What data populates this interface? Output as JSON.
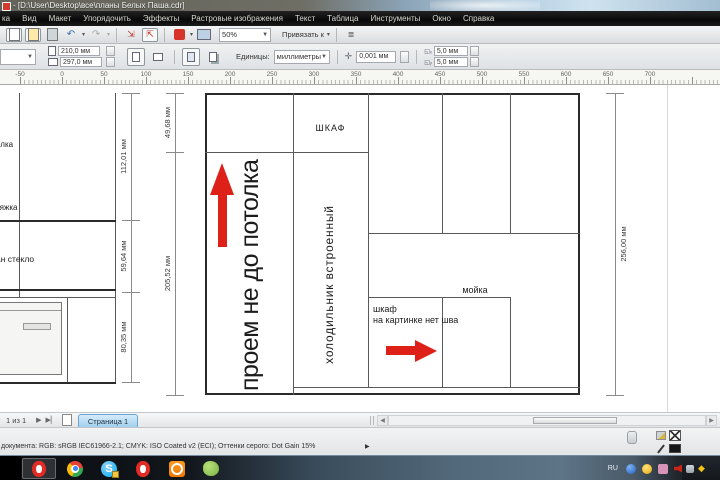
{
  "window": {
    "title": "- [D:\\User\\Desktop\\все\\планы Белых Паша.cdr]"
  },
  "menu": {
    "items": [
      "ка",
      "Вид",
      "Макет",
      "Упорядочить",
      "Эффекты",
      "Растровые изображения",
      "Текст",
      "Таблица",
      "Инструменты",
      "Окно",
      "Справка"
    ]
  },
  "toolbar": {
    "zoom_value": "50%",
    "snap_label": "Привязать к"
  },
  "property_bar": {
    "page_width": "210,0 мм",
    "page_height": "297,0 мм",
    "units_label": "Единицы:",
    "units_value": "миллиметры",
    "nudge_value": "0,001 мм",
    "dup_x": "5,0 мм",
    "dup_y": "5,0 мм"
  },
  "ruler": {
    "unit": "мм",
    "start_x": 20,
    "step": 42,
    "labels": [
      "-50",
      "0",
      "50",
      "100",
      "150",
      "200",
      "250",
      "300",
      "350",
      "400",
      "450",
      "500",
      "550",
      "600",
      "650",
      "700"
    ]
  },
  "canvas": {
    "left_drawing": {
      "label_shelf": "олка",
      "label_hood": "тяжка",
      "label_glass": "ан стекло",
      "dim_112": "112,01 мм",
      "dim_59": "59,64 мм",
      "dim_80": "80,35 мм"
    },
    "plan": {
      "label_shkaf_top": "ШКАФ",
      "label_proem": "проем не до потолка",
      "label_fridge": "холодильник встроенный",
      "label_sink": "мойка",
      "note_line1": "шкаф",
      "note_line2": "на картинке нет шва",
      "dim_top": "49,68 мм",
      "dim_left": "205,52 мм",
      "dim_right": "256,00 мм"
    }
  },
  "page_bar": {
    "page_info": "1 из 1",
    "tab_label": "Страница 1"
  },
  "status_bar": {
    "color_info": "документа: RGB: sRGB IEC61966-2.1; CMYK: ISO Coated v2 (ECI); Оттенки серого: Dot Gain 15%",
    "expand_arrow": "▶"
  },
  "taskbar": {
    "tray_lang": "RU",
    "app_icons": [
      "opera-active",
      "chrome",
      "skype",
      "opera",
      "orange-app",
      "green-app"
    ],
    "tray_icons": [
      "blue-app",
      "antivirus",
      "pink-app",
      "volume",
      "downloads",
      "flag",
      "grid-app",
      "diamond-app"
    ]
  },
  "colors": {
    "arrow_red": "#dd2018",
    "active_tab_blue": "#9ecdee",
    "menubar_black": "#0b0b0b"
  }
}
